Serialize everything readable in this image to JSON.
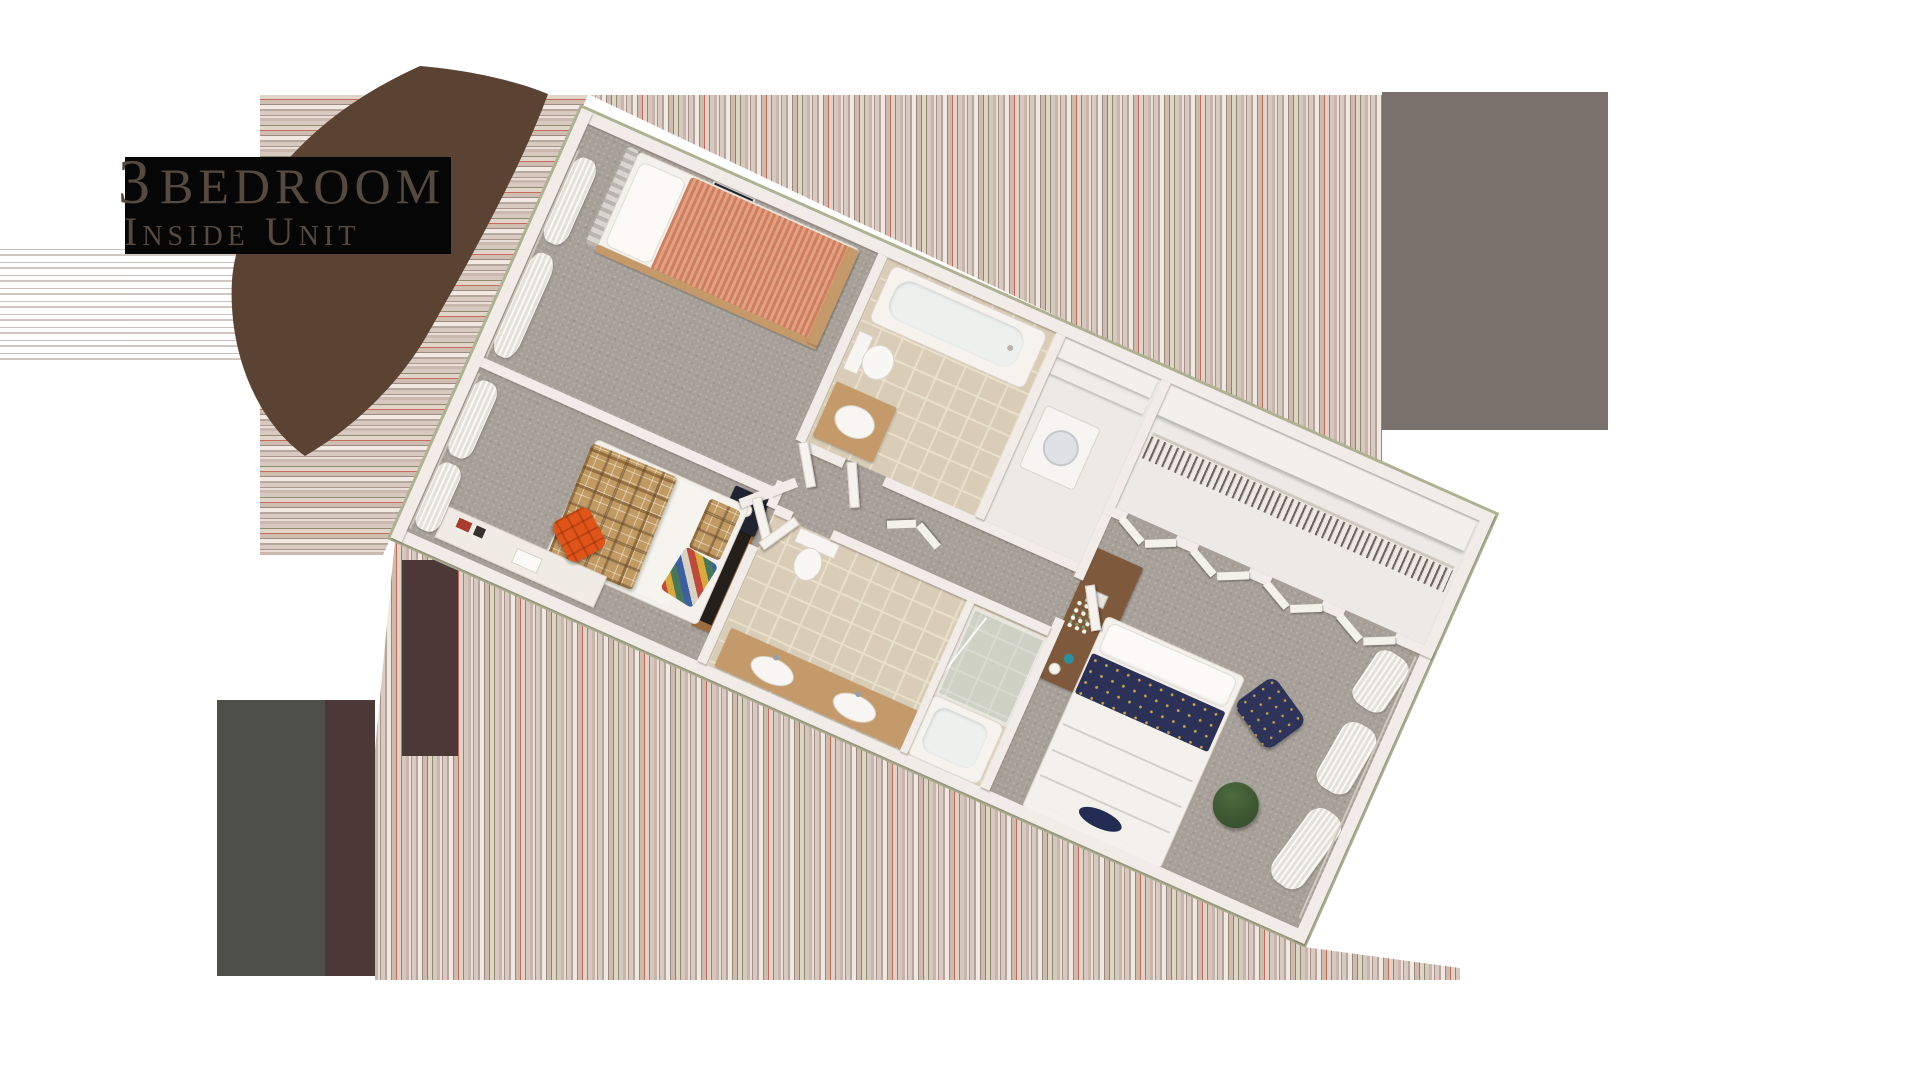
{
  "title": {
    "number": "3",
    "word": "Bedroom",
    "subtitle": "Inside Unit"
  },
  "colors": {
    "background": "#ffffff",
    "title_text": "#564a40",
    "title_backdrop": "#060606",
    "swoosh_brown": "#5a4333",
    "artifact_gray_block": "#7b716c",
    "artifact_olive_block": "#4f4f49",
    "artifact_maroon_block": "#4c3937",
    "carpet": "#a7a099",
    "wall": "#f1ece7",
    "wall_trim": "#aeb293",
    "tile": "#d9cdb7",
    "tile_grout": "#e9e0cc",
    "wood_vanity": "#c49a6b",
    "wood_desk": "#7e593b",
    "bed_salmon": "#cf7f60",
    "bed_plaid": "#c19a62",
    "bed_navy": "#2c3257",
    "chair_orange": "#e0541a",
    "chair_navy": "#2e3459",
    "plant_green": "#3a5230"
  }
}
